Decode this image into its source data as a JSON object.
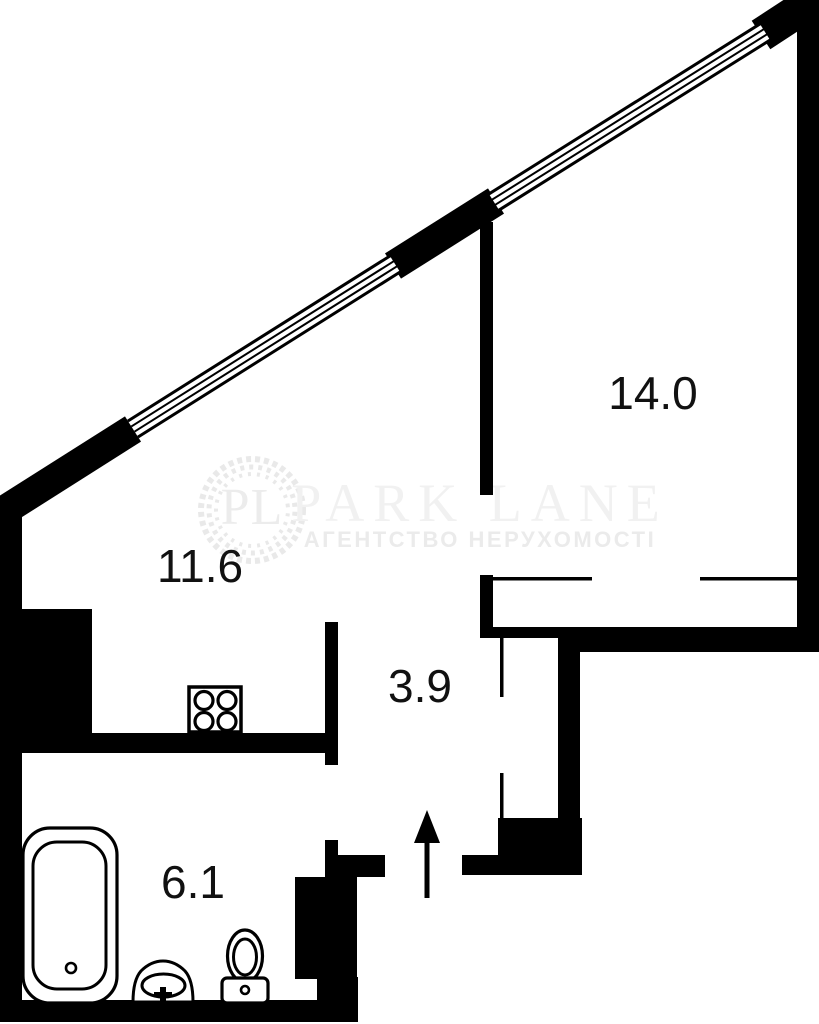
{
  "plan_title": "apartment-floor-plan",
  "watermark": {
    "logo_initials": "PL",
    "brand": "PARK LANE",
    "subtitle": "АГЕНТСТВО НЕРУХОМОСТІ"
  },
  "rooms": [
    {
      "name": "bedroom",
      "area_label": "14.0"
    },
    {
      "name": "living-kitchen",
      "area_label": "11.6"
    },
    {
      "name": "hallway",
      "area_label": "3.9"
    },
    {
      "name": "bathroom",
      "area_label": "6.1"
    }
  ],
  "fixtures": [
    "stove-4-burner",
    "bathtub",
    "pedestal-sink",
    "toilet",
    "entrance-arrow"
  ],
  "colors": {
    "walls": "#000000",
    "background": "#ffffff",
    "label_text": "#111111",
    "watermark_gray": "#ececec"
  }
}
